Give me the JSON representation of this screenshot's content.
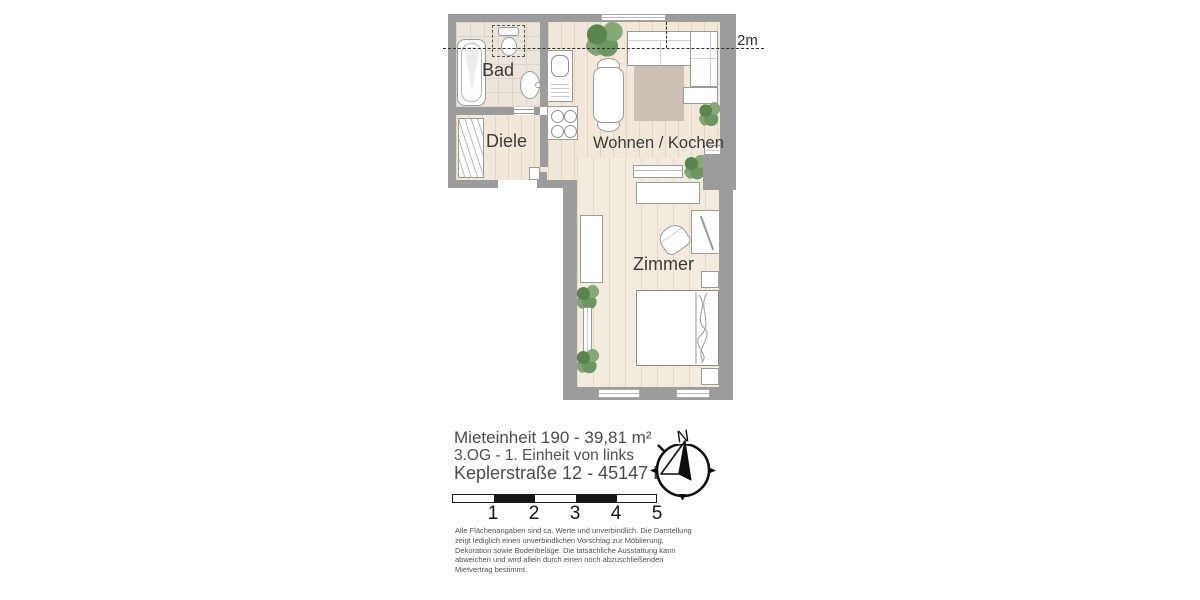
{
  "rooms": {
    "bad": "Bad",
    "diele": "Diele",
    "wohnen": "Wohnen / Kochen",
    "zimmer": "Zimmer"
  },
  "plan": {
    "height_label": "2m"
  },
  "info": {
    "line1": "Mieteinheit 190 - 39,81 m²",
    "line2": "3.OG - 1. Einheit von links",
    "line3": "Keplerstraße 12 - 45147 Essen"
  },
  "scale": {
    "ticks": [
      "1",
      "2",
      "3",
      "4",
      "5"
    ]
  },
  "compass": {
    "label": "N"
  },
  "disclaimer": "Alle Flächenangaben sind ca. Werte und unverbindlich. Die Darstellung\nzeigt lediglich einen unverbindlichen Vorschlag zur Möblierung,\nDekoration sowie Bodenbeläge. Die tatsächliche  Ausstattung kann\nabweichen und wird allein durch einen noch abzuschließenden\nMietvertrag bestimmt.",
  "colors": {
    "wall": "#9c9c9c",
    "floor_tile": "#ece5dc",
    "floor_wood": "#f1e8da",
    "rug": "#cbc0b4",
    "plant_green": "#6d9661",
    "text": "#454545"
  }
}
